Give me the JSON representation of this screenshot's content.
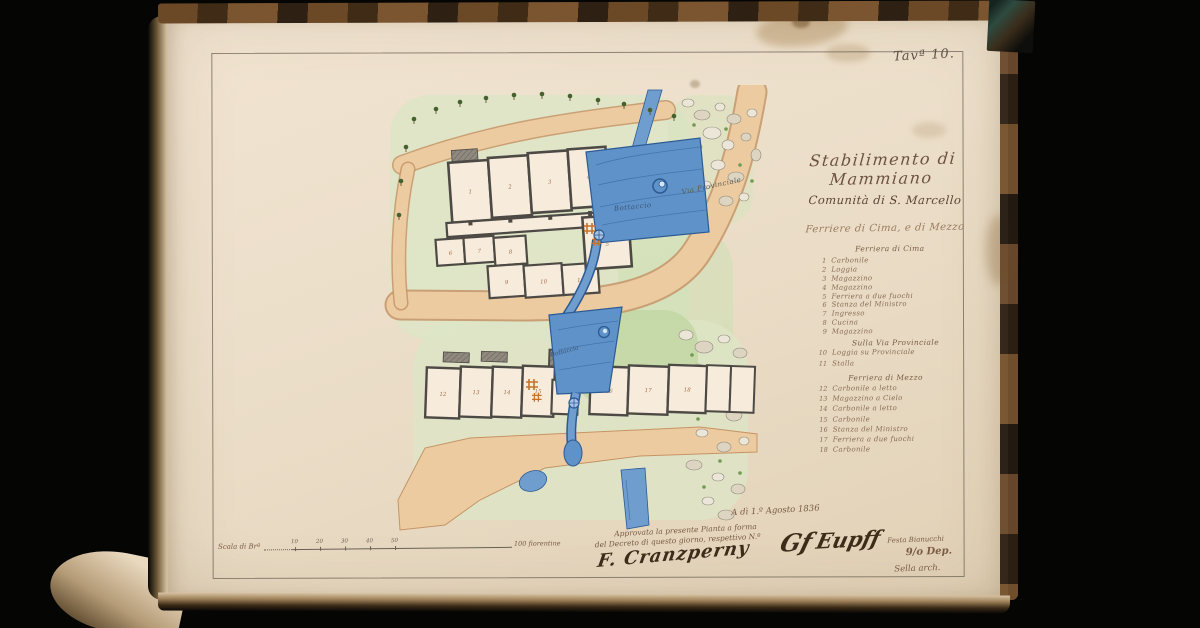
{
  "page": {
    "tav_label": "Tavª 10.",
    "title": "Stabilimento di Mammiano",
    "subtitle": "Comunità di S. Marcello",
    "subtitle2": "Ferriere di Cima, e di Mezzo",
    "legend": {
      "section1": "Ferriera di Cima",
      "items1": [
        {
          "n": "1",
          "label": "Carbonile"
        },
        {
          "n": "2",
          "label": "Loggia"
        },
        {
          "n": "3",
          "label": "Magazzino"
        },
        {
          "n": "4",
          "label": "Magazzino"
        },
        {
          "n": "5",
          "label": "Ferriera a due fuochi"
        },
        {
          "n": "6",
          "label": "Stanza del Ministro"
        },
        {
          "n": "7",
          "label": "Ingresso"
        },
        {
          "n": "8",
          "label": "Cucina"
        },
        {
          "n": "9",
          "label": "Magazzino"
        }
      ],
      "subheader": "Sulla Via Provinciale",
      "items2": [
        {
          "n": "10",
          "label": "Loggia su Provinciale"
        },
        {
          "n": "11",
          "label": "Stalla"
        }
      ],
      "section2": "Ferriera di Mezzo",
      "items3": [
        {
          "n": "12",
          "label": "Carbonile a letto"
        },
        {
          "n": "13",
          "label": "Magazzino a Cielo"
        },
        {
          "n": "14",
          "label": "Carbonile a letto"
        },
        {
          "n": "15",
          "label": "Carbonile"
        },
        {
          "n": "16",
          "label": "Stanza del Ministro"
        },
        {
          "n": "17",
          "label": "Ferriera a due fuochi"
        },
        {
          "n": "18",
          "label": "Carbonile"
        }
      ]
    },
    "scale": {
      "prefix": "Scala di Brª",
      "ticks": [
        "10",
        "20",
        "30",
        "40",
        "50"
      ],
      "suffix": "100 fiorentine"
    },
    "approval": {
      "date": "A dì 1.º Agosto 1836",
      "line1": "Approvata la presente Pianta a forma",
      "line2": "del Decreto di questo giorno, respettivo N.º",
      "signature1": "F. Cranzperny",
      "signature2": "Gf",
      "signature3": "Eupff"
    },
    "corner": {
      "line1": "Festa Bianucchi",
      "line2": "9/o Dep.",
      "line3": "Sella arch."
    },
    "plan": {
      "labels": {
        "bottaccio_upper": "Bottaccio",
        "bottaccio_lower": "Bottaccio",
        "via": "Via Provinciale"
      },
      "room_numbers": [
        "1",
        "2",
        "3",
        "4",
        "5",
        "6",
        "7",
        "8",
        "9",
        "10",
        "11",
        "12",
        "13",
        "14",
        "15",
        "16",
        "17",
        "18"
      ],
      "colors": {
        "water": "#5f92c8",
        "road": "#edcba1",
        "grass": "#dce6c5",
        "walls": "#4d4a45",
        "forge_mark": "#c4722c",
        "page": "#ecdfca"
      }
    }
  }
}
